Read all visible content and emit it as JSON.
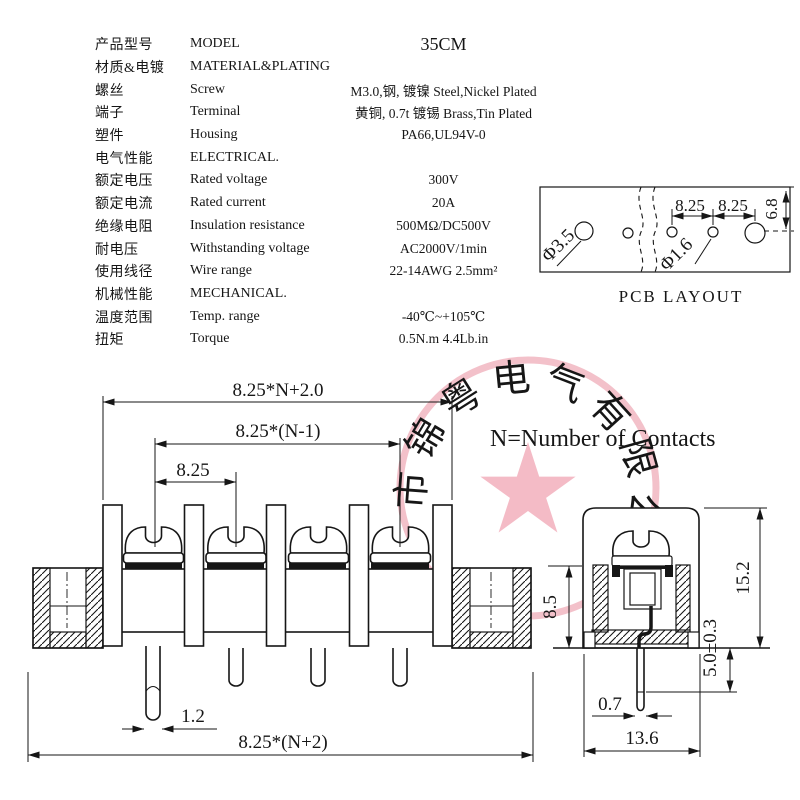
{
  "table": {
    "rows": [
      {
        "cn": "产品型号",
        "en": "MODEL",
        "value": "35CM"
      },
      {
        "cn": "材质&电镀",
        "en": "MATERIAL&PLATING",
        "value": ""
      },
      {
        "cn": "螺丝",
        "en": "Screw",
        "value": "M3.0,钢, 镀镍 Steel,Nickel Plated"
      },
      {
        "cn": "端子",
        "en": "Terminal",
        "value": "黄铜, 0.7t 镀锡 Brass,Tin Plated"
      },
      {
        "cn": "塑件",
        "en": "Housing",
        "value": "PA66,UL94V-0"
      },
      {
        "cn": "电气性能",
        "en": "ELECTRICAL.",
        "value": ""
      },
      {
        "cn": "额定电压",
        "en": "Rated voltage",
        "value": "300V"
      },
      {
        "cn": "额定电流",
        "en": "Rated current",
        "value": "20A"
      },
      {
        "cn": "绝缘电阻",
        "en": "Insulation resistance",
        "value": "500MΩ/DC500V"
      },
      {
        "cn": "耐电压",
        "en": "Withstanding voltage",
        "value": "AC2000V/1min"
      },
      {
        "cn": "使用线径",
        "en": "Wire range",
        "value": "22-14AWG 2.5mm²"
      },
      {
        "cn": "机械性能",
        "en": "MECHANICAL.",
        "value": ""
      },
      {
        "cn": "温度范围",
        "en": "Temp. range",
        "value": "-40℃~+105℃"
      },
      {
        "cn": "扭矩",
        "en": "Torque",
        "value": "0.5N.m  4.4Lb.in"
      }
    ]
  },
  "note": "N=Number of Contacts",
  "front_view": {
    "dims": {
      "top_overall": "8.25*N+2.0",
      "pitch_span": "8.25*(N-1)",
      "pitch": "8.25",
      "pin_width": "1.2",
      "bottom_overall": "8.25*(N+2)"
    }
  },
  "side_view": {
    "dims": {
      "total_height": "15.2",
      "body_height": "8.5",
      "pin_length": "5.0±0.3",
      "pin_width": "0.7",
      "width": "13.6"
    }
  },
  "pcb": {
    "title": "PCB LAYOUT",
    "big_hole": "Φ3.5",
    "small_hole": "Φ1.6",
    "pitch_a": "8.25",
    "pitch_b": "8.25",
    "edge_offset": "6.8"
  },
  "watermark": {
    "text": "市锦粤电气有限公司",
    "color": "#e2637a"
  },
  "colors": {
    "line": "#161616",
    "background": "#ffffff"
  }
}
